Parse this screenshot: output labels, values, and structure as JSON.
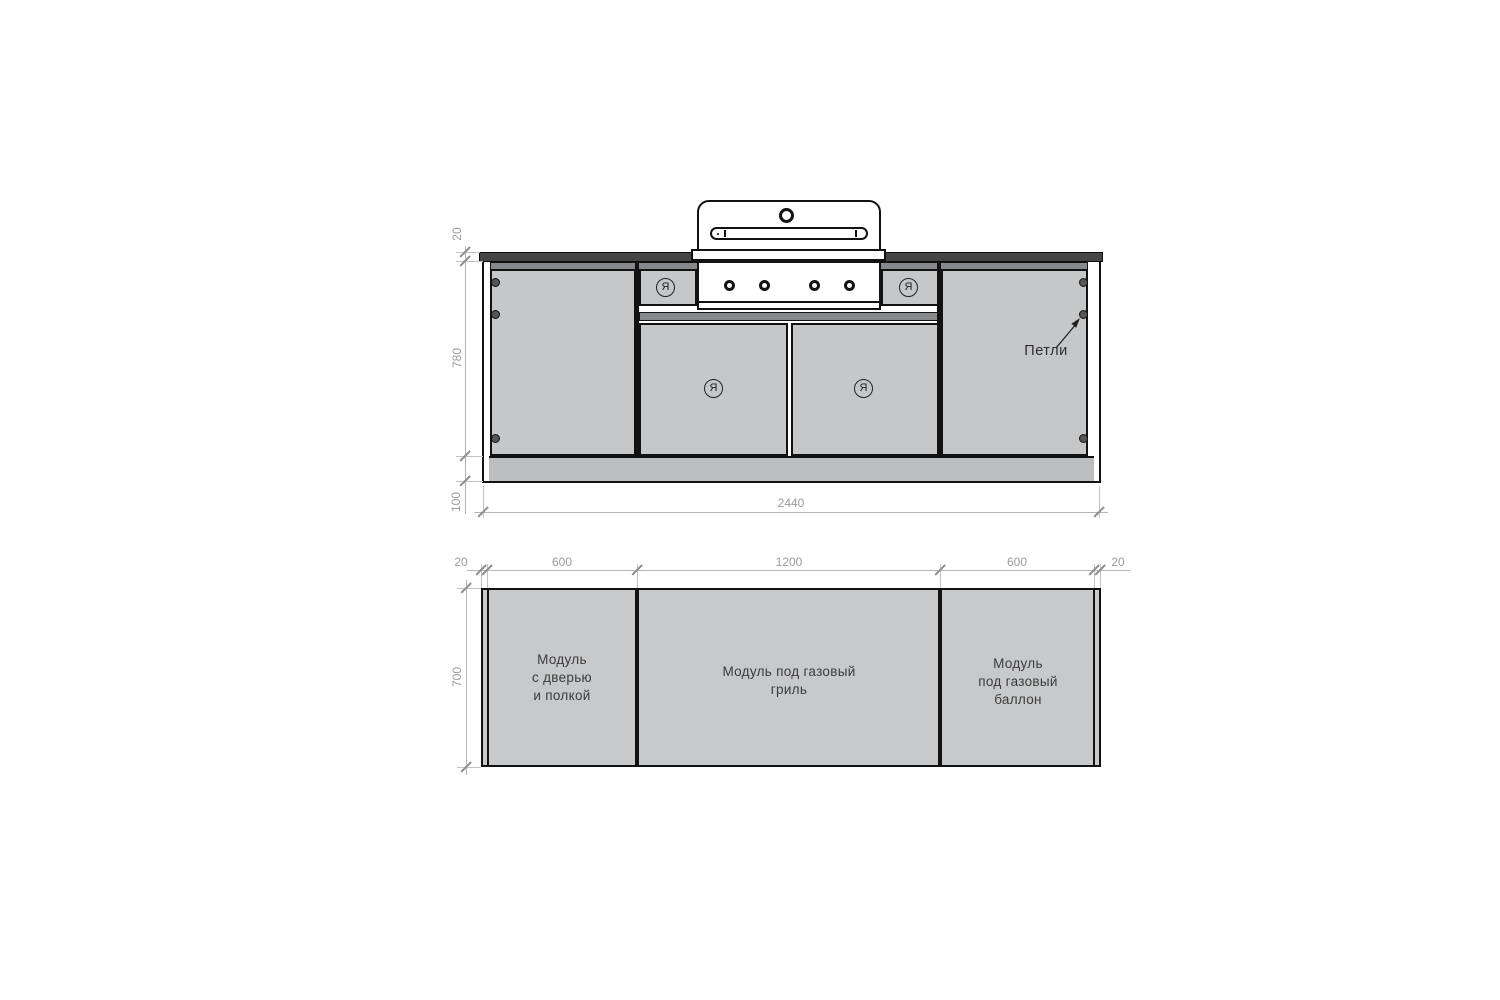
{
  "drawing": {
    "front_view": {
      "hinge_callout": "Петли",
      "door_symbol": "Я",
      "dimensions": {
        "countertop_thickness_mm": "20",
        "body_height_mm": "780",
        "plinth_height_mm": "100",
        "total_width_mm": "2440"
      }
    },
    "plan_view": {
      "dimensions": {
        "left_panel_mm": "20",
        "left_module_mm": "600",
        "center_module_mm": "1200",
        "right_module_mm": "600",
        "right_panel_mm": "20",
        "depth_mm": "700"
      },
      "modules": [
        {
          "lines": [
            "Модуль",
            "с дверью",
            "и полкой"
          ]
        },
        {
          "lines": [
            "Модуль под газовый",
            "гриль"
          ]
        },
        {
          "lines": [
            "Модуль",
            "под газовый",
            "баллон"
          ]
        }
      ]
    },
    "colors": {
      "panel_gray": "#c6c7c9",
      "rail_gray": "#87888b",
      "countertop_dark": "#454545",
      "outline_black": "#121212",
      "dimension_gray": "#9b9b9b"
    }
  }
}
